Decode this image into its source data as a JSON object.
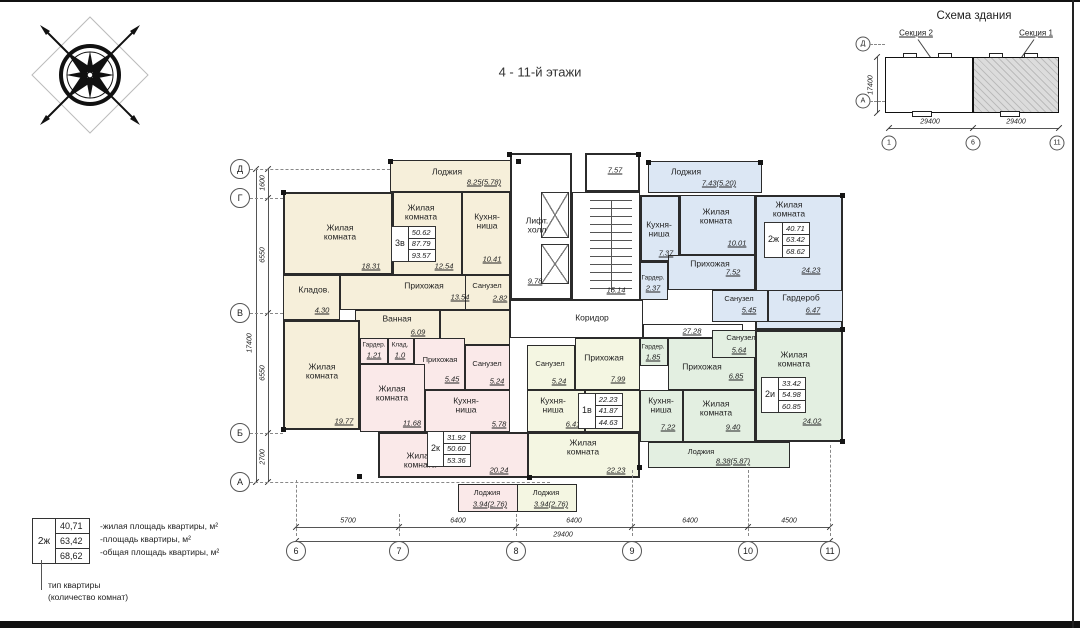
{
  "page": {
    "title": "4 - 11-й этажи"
  },
  "schema": {
    "title": "Схема здания",
    "section2": "Секция 2",
    "section1": "Секция 1",
    "dim_left": "29400",
    "dim_right": "29400",
    "dim_height": "17400",
    "axis_nums": [
      "1",
      "6",
      "11"
    ],
    "axis_letters": [
      "Д",
      "А"
    ]
  },
  "legend": {
    "type": "2ж",
    "values": [
      "40,71",
      "63,42",
      "68,62"
    ],
    "lines": [
      "-жилая площадь квартиры, м²",
      "-площадь квартиры, м²",
      "-общая площадь квартиры, м²"
    ],
    "caption1": "тип квартиры",
    "caption2": "(количество комнат)"
  },
  "axes": {
    "left": {
      "labels": [
        "Д",
        "Г",
        "В",
        "Б",
        "А"
      ],
      "dims": [
        "1600",
        "6550",
        "6550",
        "2700"
      ],
      "total": "17400"
    },
    "bottom": {
      "labels": [
        "6",
        "7",
        "8",
        "9",
        "10",
        "11"
      ],
      "dims": [
        "5700",
        "6400",
        "6400",
        "6400",
        "4500"
      ],
      "total": "29400"
    }
  },
  "common": {
    "vestibule_area": "7.57",
    "lift_label": "Лифт.\nхолл",
    "lift_area": "9.78",
    "stairs_area": "15.14",
    "corridor_label": "Коридор",
    "corridor_dim": "27.28"
  },
  "apartments": {
    "a3v": {
      "type": "3в",
      "stats": [
        "50.62",
        "87.79",
        "93.57"
      ],
      "loggia": "Лоджия",
      "loggia_a": "8.25(5.78)",
      "living1": "Жилая\nкомната",
      "living1_a": "18.31",
      "living2": "Жилая\nкомната",
      "living2_a": "12.54",
      "kitchen": "Кухня-\nниша",
      "kitchen_a": "10.41",
      "hall": "Прихожая",
      "hall_a": "13.54",
      "wc": "Санузел",
      "wc_a": "2.82",
      "storage": "Кладов.",
      "storage_a": "4.30",
      "bath": "Ванная",
      "bath_a": "6.09",
      "living3": "Жилая\nкомната",
      "living3_a": "19.77"
    },
    "a2k": {
      "type": "2к",
      "stats": [
        "31.92",
        "50.60",
        "53.36"
      ],
      "wardrobe": "Гардер.",
      "wardrobe_a": "1.21",
      "storage": "Клад.",
      "storage_a": "1.0",
      "hall": "Прихожая",
      "hall_a": "5.45",
      "wc": "Санузел",
      "wc_a": "5.24",
      "kitchen": "Кухня-\nниша",
      "kitchen_a": "5.78",
      "living1": "Жилая\nкомната",
      "living1_a": "11.68",
      "living2": "Жилая\nкомната",
      "living2_a": "20.24",
      "loggia": "Лоджия",
      "loggia_a": "3.94(2.76)"
    },
    "a1v": {
      "type": "1в",
      "stats": [
        "22.23",
        "41.87",
        "44.63"
      ],
      "wc": "Санузел",
      "wc_a": "5.24",
      "hall": "Прихожая",
      "hall_a": "7.99",
      "kitchen": "Кухня-\nниша",
      "kitchen_a": "6.41",
      "living": "Жилая\nкомната",
      "living_a": "22.23",
      "loggia": "Лоджия",
      "loggia_a": "3.94(2.76)"
    },
    "a2zh": {
      "type": "2ж",
      "stats": [
        "40.71",
        "63.42",
        "68.62"
      ],
      "loggia": "Лоджия",
      "loggia_a": "7.43(5.20)",
      "kitchen": "Кухня-\nниша",
      "kitchen_a": "7.37",
      "living1": "Жилая\nкомната",
      "living1_a": "10.01",
      "living2": "Жилая\nкомната",
      "living2_a": "24.23",
      "hall": "Прихожая",
      "hall_a": "7.52",
      "wardrobe1": "Гардер.",
      "wardrobe1_a": "2.37",
      "wc": "Санузел",
      "wc_a": "5.45",
      "wardrobe2": "Гардероб",
      "wardrobe2_a": "6.47"
    },
    "a2i": {
      "type": "2и",
      "stats": [
        "33.42",
        "54.98",
        "60.85"
      ],
      "wardrobe": "Гардер.",
      "wardrobe_a": "1.85",
      "wc": "Санузел",
      "wc_a": "5.64",
      "hall": "Прихожая",
      "hall_a": "6.85",
      "kitchen": "Кухня-\nниша",
      "kitchen_a": "7.22",
      "living1": "Жилая\nкомната",
      "living1_a": "9.40",
      "living2": "Жилая\nкомната",
      "living2_a": "24.02",
      "loggia": "Лоджия",
      "loggia_a": "8.38(5.87)"
    }
  }
}
